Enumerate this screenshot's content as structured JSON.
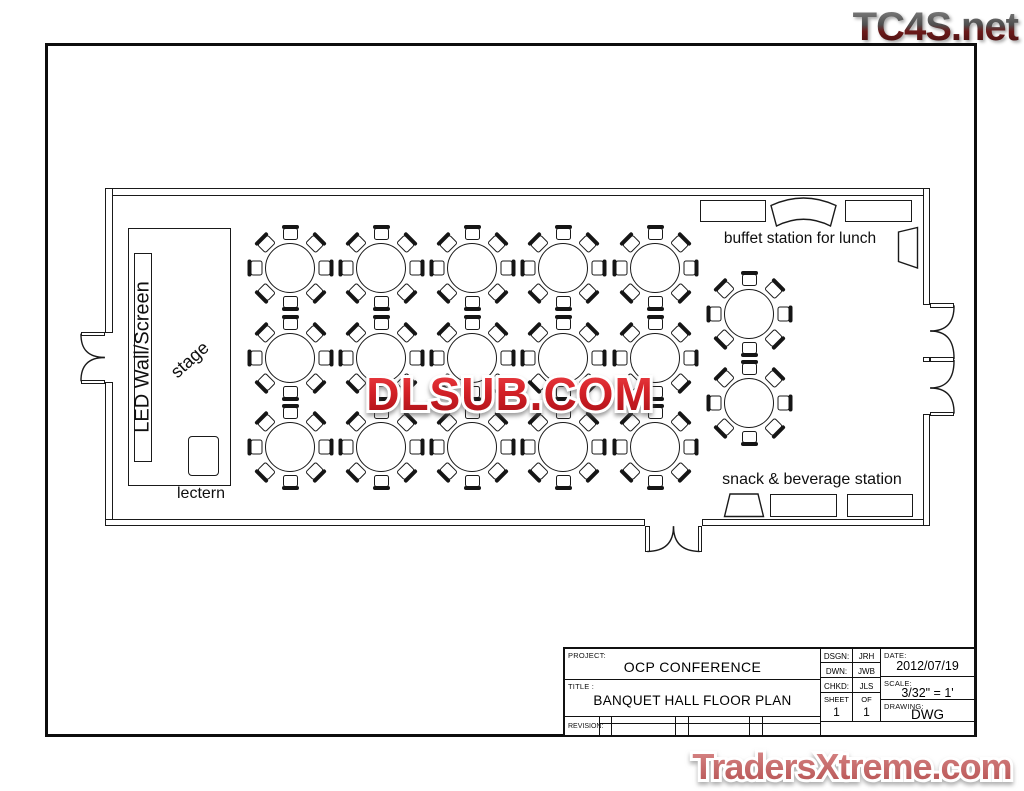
{
  "watermarks": {
    "top": "TC4S.net",
    "center": "DLSUB.COM",
    "bottom": "TradersXtreme.com",
    "colors": {
      "top_gradient": [
        "#8d8d8d",
        "#4f4f4f",
        "#6b1a1a",
        "#3c0d0d"
      ],
      "center_red": "#d42127",
      "bottom_salmon": "#c05c5c"
    }
  },
  "plan": {
    "labels": {
      "led_wall": "LED Wall/Screen",
      "stage": "stage",
      "lectern": "lectern",
      "buffet": "buffet station for lunch",
      "snack": "snack & beverage station"
    },
    "tables": {
      "count": 17,
      "seats_per_table": 8,
      "positions": [
        {
          "x": 290,
          "y": 268
        },
        {
          "x": 381,
          "y": 268
        },
        {
          "x": 472,
          "y": 268
        },
        {
          "x": 563,
          "y": 268
        },
        {
          "x": 655,
          "y": 268
        },
        {
          "x": 290,
          "y": 358
        },
        {
          "x": 381,
          "y": 358
        },
        {
          "x": 472,
          "y": 358
        },
        {
          "x": 563,
          "y": 358
        },
        {
          "x": 655,
          "y": 358
        },
        {
          "x": 290,
          "y": 447
        },
        {
          "x": 381,
          "y": 447
        },
        {
          "x": 472,
          "y": 447
        },
        {
          "x": 563,
          "y": 447
        },
        {
          "x": 655,
          "y": 447
        },
        {
          "x": 749,
          "y": 314
        },
        {
          "x": 749,
          "y": 403
        }
      ]
    },
    "line_color": "#1a1a1a"
  },
  "title_block": {
    "project_label": "PROJECT:",
    "project": "OCP CONFERENCE",
    "title_label": "TITLE :",
    "title": "BANQUET HALL FLOOR PLAN",
    "revision_label": "REVISION:",
    "dsgn_label": "DSGN:",
    "dsgn": "JRH",
    "dwn_label": "DWN:",
    "dwn": "JWB",
    "chkd_label": "CHKD:",
    "chkd": "JLS",
    "sheet_label": "SHEET",
    "of_label": "OF",
    "sheet": "1",
    "of": "1",
    "date_label": "DATE:",
    "date": "2012/07/19",
    "scale_label": "SCALE:",
    "scale": "3/32\" = 1'",
    "drawing_label": "DRAWING:",
    "drawing": "DWG"
  }
}
